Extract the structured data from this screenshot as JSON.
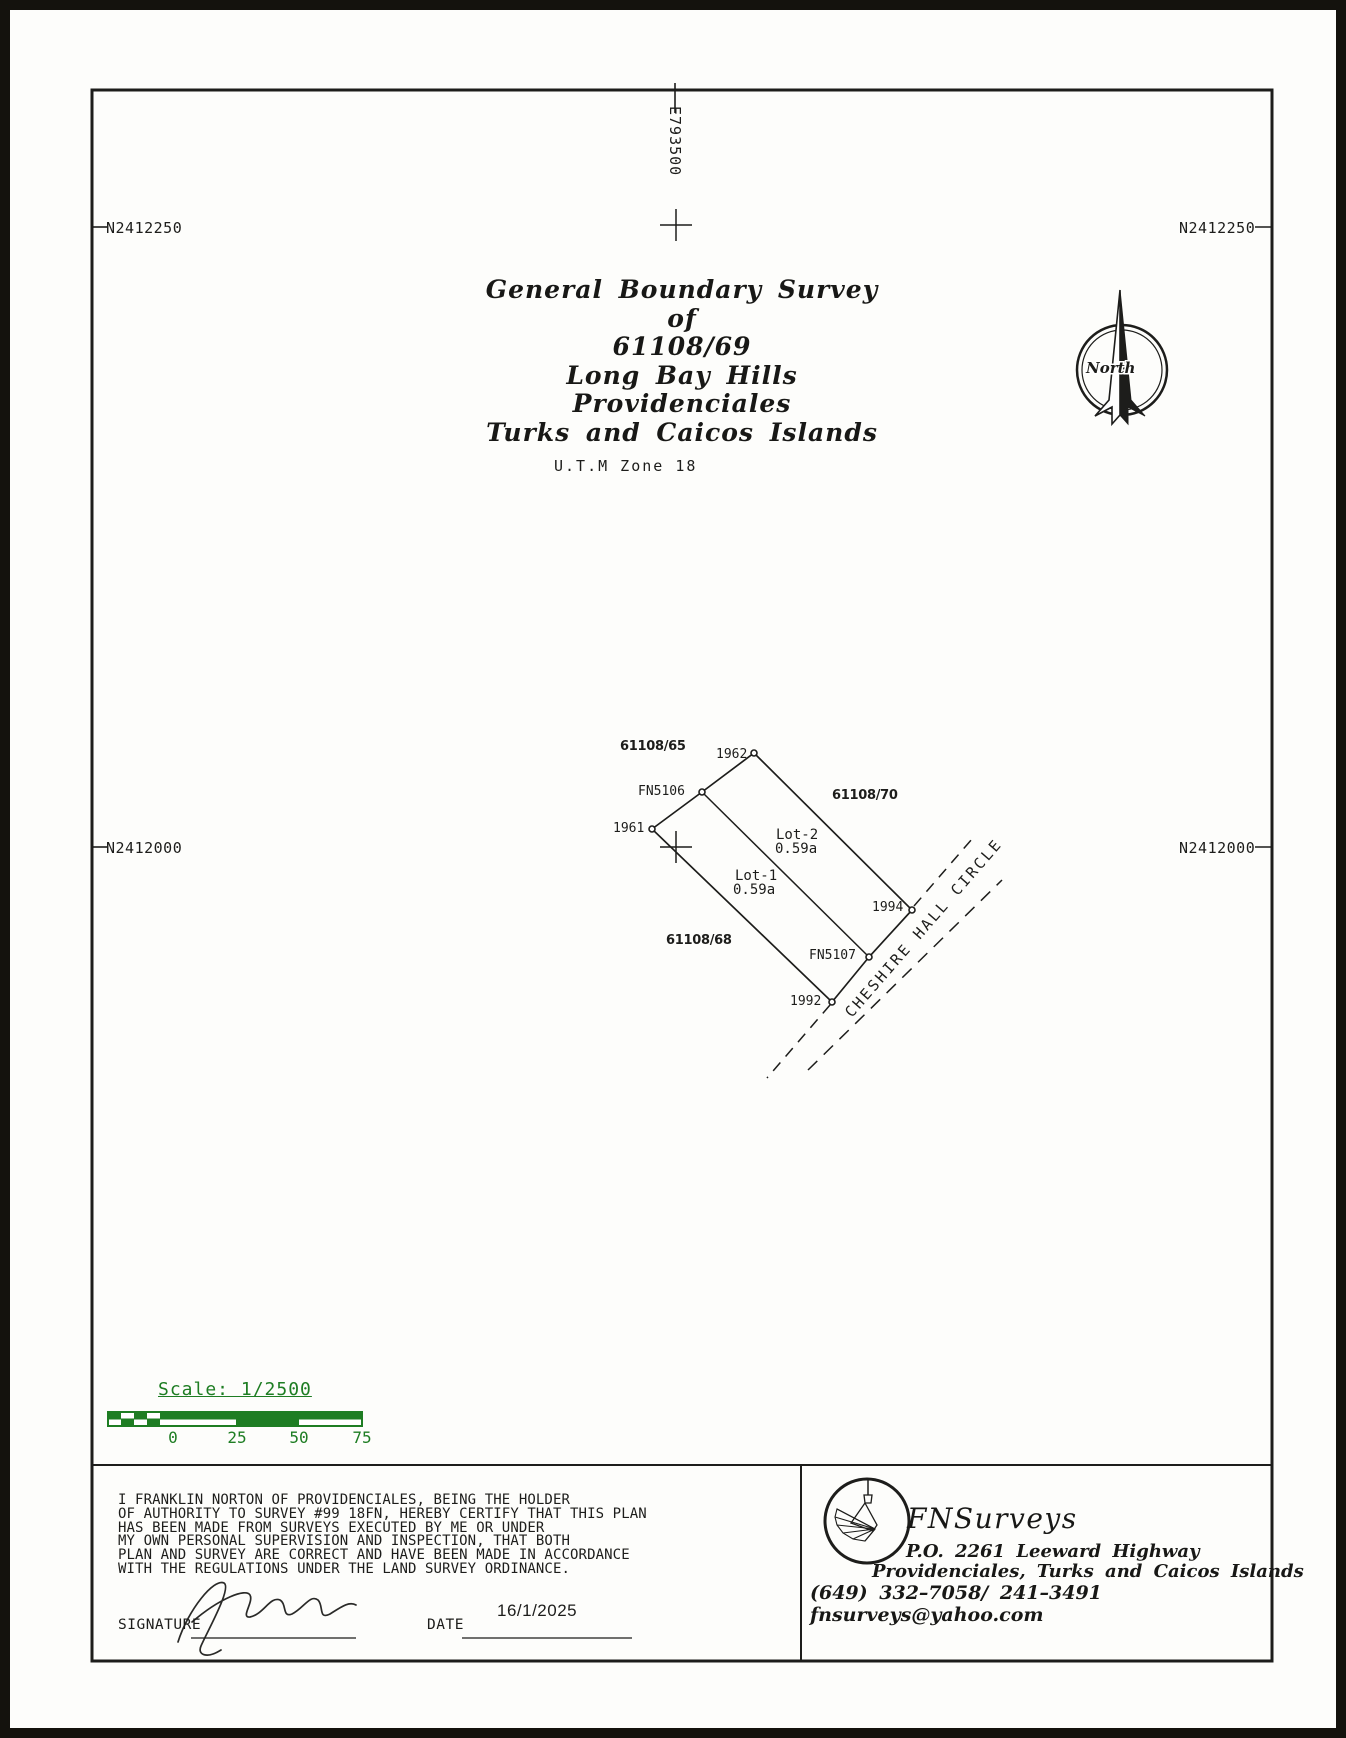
{
  "title": {
    "lines": [
      "General Boundary Survey",
      "of",
      "61108/69",
      "Long Bay Hills",
      "Providenciales",
      "Turks and Caicos Islands"
    ],
    "utm": "U.T.M Zone 18"
  },
  "grid": {
    "easting": "E793500",
    "northing_upper": "N2412250",
    "northing_lower": "N2412000"
  },
  "compass": {
    "label": "North"
  },
  "map": {
    "adjacent_parcels": [
      "61108/65",
      "61108/70",
      "61108/68"
    ],
    "point_labels": [
      "1962",
      "FN5106",
      "1961",
      "1994",
      "FN5107",
      "1992"
    ],
    "lot1_name": "Lot-1",
    "lot1_area": "0.59a",
    "lot2_name": "Lot-2",
    "lot2_area": "0.59a",
    "road_name": "CHESHIRE HALL CIRCLE"
  },
  "scalebar": {
    "label": "Scale: 1/2500",
    "ticks": [
      "0",
      "25",
      "50",
      "75"
    ],
    "green": "#1e7d23"
  },
  "certification": {
    "lines": [
      "I FRANKLIN NORTON OF PROVIDENCIALES, BEING THE HOLDER",
      "OF AUTHORITY TO SURVEY #99 18FN, HEREBY CERTIFY THAT THIS PLAN",
      "HAS BEEN MADE FROM SURVEYS EXECUTED BY ME OR UNDER",
      "MY OWN PERSONAL SUPERVISION  AND INSPECTION, THAT BOTH",
      "PLAN AND SURVEY ARE CORRECT AND HAVE BEEN MADE IN ACCORDANCE",
      "WITH THE REGULATIONS UNDER THE LAND SURVEY ORDINANCE."
    ],
    "signature_label": "SIGNATURE",
    "date_label": "DATE",
    "date_value": "16/1/2025"
  },
  "surveyor": {
    "name": "FNSurveys",
    "po_box": "P.O. 2261 Leeward Highway",
    "location": "Providenciales, Turks and Caicos Islands",
    "phone": "(649) 332–7058/ 241–3491",
    "email": "fnsurveys@yahoo.com"
  }
}
